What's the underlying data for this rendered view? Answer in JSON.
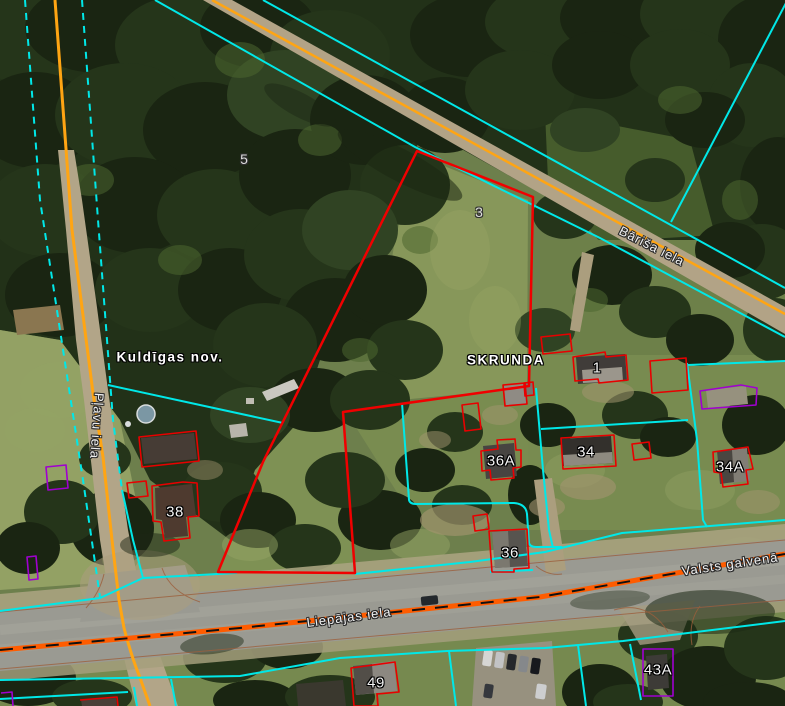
{
  "map": {
    "description": "Cadastral aerial map view of Skrunda, Latvia with parcel and building overlays",
    "labels": {
      "plot5": {
        "text": "5",
        "kind": "parcel-number"
      },
      "plot3": {
        "text": "3",
        "kind": "parcel-number"
      },
      "kuldigas": {
        "text": "Kuldīgas nov.",
        "kind": "admin-area"
      },
      "skrunda": {
        "text": "SKRUNDA",
        "kind": "admin-area"
      },
      "barisa": {
        "text": "Bāriša iela",
        "kind": "street-name"
      },
      "plavu": {
        "text": "Pļavu iela",
        "kind": "street-name"
      },
      "liepajas": {
        "text": "Liepājas iela",
        "kind": "street-name"
      },
      "valsts": {
        "text": "Valsts galvenā",
        "kind": "street-name"
      },
      "b38": {
        "text": "38",
        "kind": "house-number"
      },
      "b1": {
        "text": "1",
        "kind": "house-number"
      },
      "b36a": {
        "text": "36A",
        "kind": "house-number"
      },
      "b34": {
        "text": "34",
        "kind": "house-number"
      },
      "b34a": {
        "text": "34A",
        "kind": "house-number"
      },
      "b36": {
        "text": "36",
        "kind": "house-number"
      },
      "b49": {
        "text": "49",
        "kind": "house-number"
      },
      "b43a": {
        "text": "43A",
        "kind": "house-number"
      }
    },
    "palette": {
      "parcel_boundary_red": "#f00000",
      "building_outline_red": "#e80000",
      "cadastral_line_cyan": "#00e8e8",
      "road_axis_orange": "#ffa513",
      "main_road_orange": "#ff5c00",
      "main_road_dash_black": "#111111",
      "protected_outline_purple": "#a000d0",
      "label_text": "#ffffff",
      "label_halo": "#000000"
    }
  }
}
